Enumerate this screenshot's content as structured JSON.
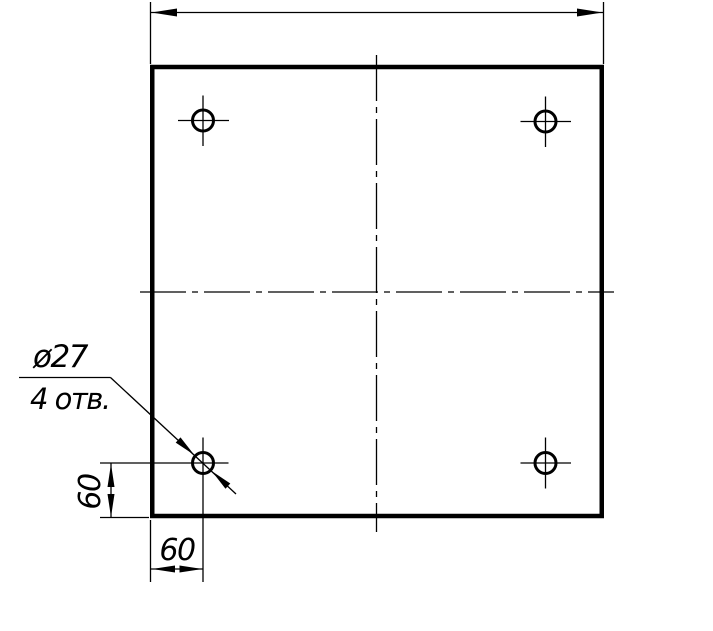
{
  "drawing": {
    "type": "technical-drawing-plate-with-holes",
    "background_color": "#ffffff",
    "line_color": "#000000",
    "callout": {
      "diameter_label": "ø27",
      "holes_count_label": "4 отв."
    },
    "dimensions": {
      "hole_offset_vertical": "60",
      "hole_offset_horizontal": "60"
    }
  }
}
